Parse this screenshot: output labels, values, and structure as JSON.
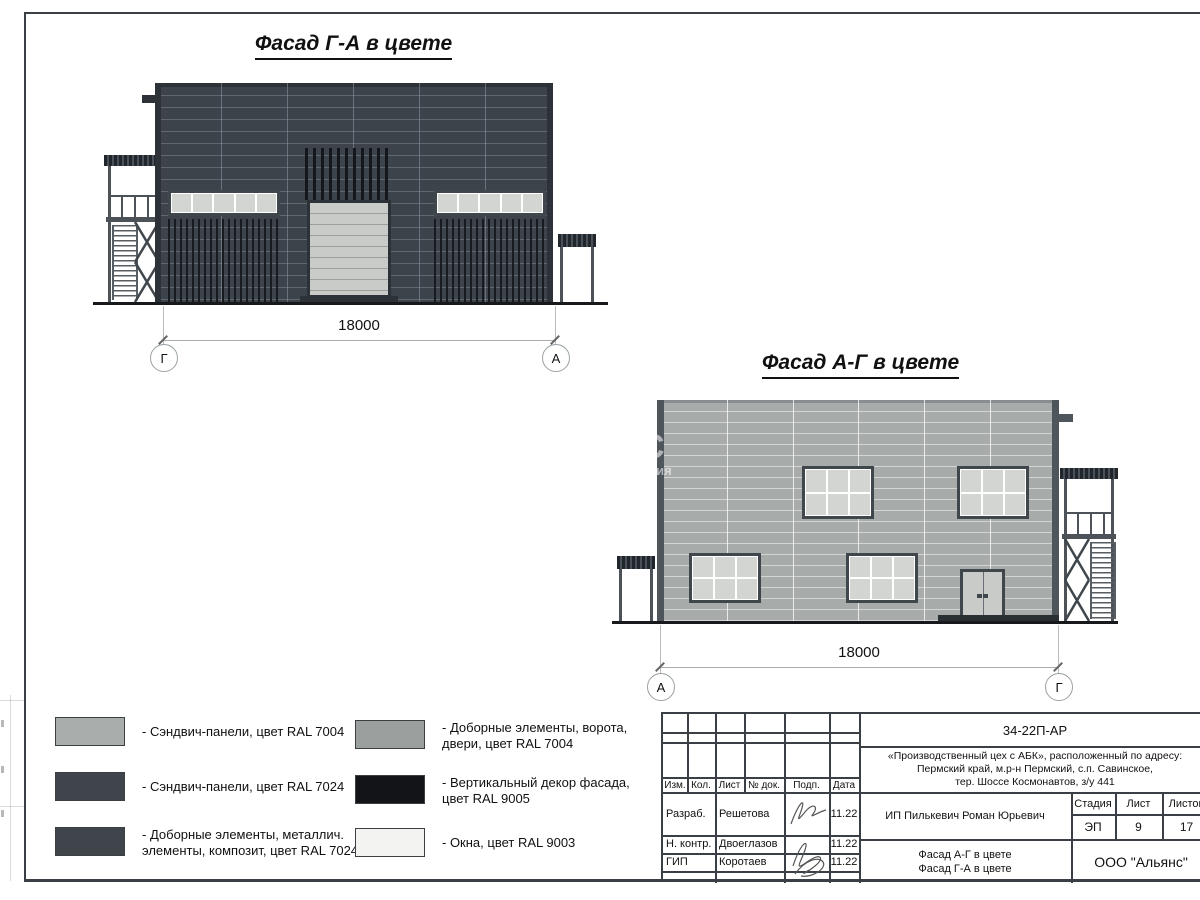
{
  "facade1": {
    "title": "Фасад Г-А в цвете",
    "dimension": "18000",
    "axis_left": "Г",
    "axis_right": "А"
  },
  "facade2": {
    "title": "Фасад А-Г в цвете",
    "dimension": "18000",
    "axis_left": "А",
    "axis_right": "Г"
  },
  "watermark": {
    "big": "С",
    "small": "ания"
  },
  "legend": {
    "items": [
      {
        "line1": "- Сэндвич-панели, цвет RAL 7004",
        "line2": "",
        "color": "#a9adab"
      },
      {
        "line1": "- Сэндвич-панели, цвет RAL 7024",
        "line2": "",
        "color": "#3f454b"
      },
      {
        "line1": "- Доборные элементы, металлич.",
        "line2": "элементы, композит, цвет RAL 7024",
        "color": "#3f454b"
      },
      {
        "line1": "- Доборные элементы, ворота,",
        "line2": "двери, цвет RAL 7004",
        "color": "#9b9f9d"
      },
      {
        "line1": "- Вертикальный декор фасада,",
        "line2": "цвет RAL 9005",
        "color": "#121418"
      },
      {
        "line1": "- Окна, цвет RAL 9003",
        "line2": "",
        "color": "#f3f4f2"
      }
    ]
  },
  "titleblock": {
    "doc_number": "34-22П-АР",
    "project_lines": [
      "«Производственный цех с АБК», расположенный по адресу:",
      "Пермский край, м.р-н Пермский, с.п. Савинское,",
      "тер. Шоссе Космонавтов, з/у 441"
    ],
    "cols": [
      "Изм.",
      "Кол.",
      "Лист",
      "№ док.",
      "Подп.",
      "Дата"
    ],
    "sign_rows": [
      {
        "role": "Разраб.",
        "name": "Решетова",
        "date": "11.22"
      },
      {
        "role": "Н. контр.",
        "name": "Двоеглазов",
        "date": "11.22"
      },
      {
        "role": "ГИП",
        "name": "Коротаев",
        "date": "11.22"
      }
    ],
    "client": "ИП Пилькевич Роман Юрьевич",
    "stage_label": "Стадия",
    "stage": "ЭП",
    "sheet_label": "Лист",
    "sheet": "9",
    "sheets_label": "Листов",
    "sheets": "17",
    "sheet_title_line1": "Фасад А-Г в цвете",
    "sheet_title_line2": "Фасад Г-А в цвете",
    "company": "ООО \"Альянс\""
  },
  "colors": {
    "ral7004": "#a7aba9",
    "ral7024": "#3d434a",
    "ral9005": "#14181c",
    "ral9003": "#f4f5f4",
    "trim": "#2c3238",
    "pane": "#d2d5d2",
    "gate": "#c9cbc8"
  }
}
